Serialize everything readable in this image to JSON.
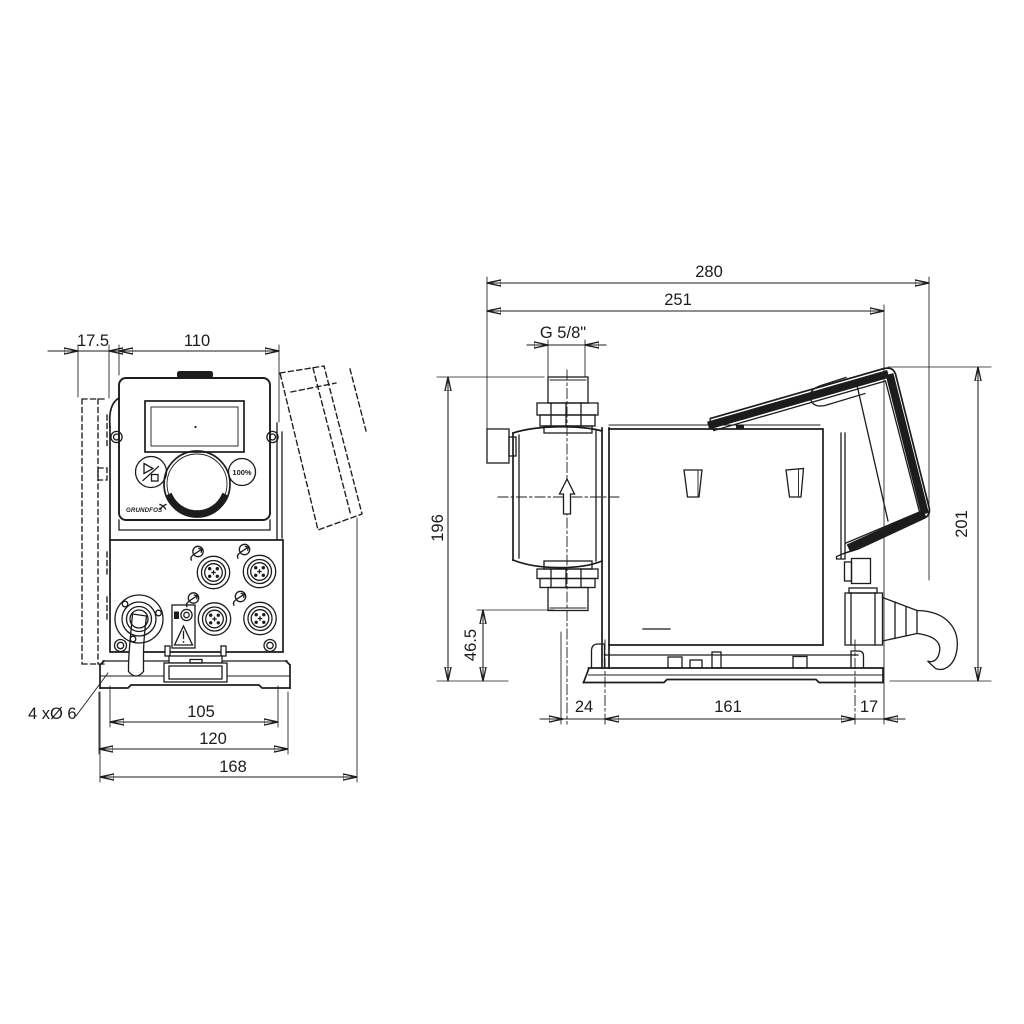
{
  "title": "Dosing pump dimensional drawing",
  "front_view": {
    "dims": {
      "wall_offset": "17.5",
      "panel_width": "110",
      "hole_spacing": "105",
      "plate_width": "120",
      "overall_width": "168"
    },
    "holes_label": "4 xØ 6",
    "panel": {
      "logo": "GRUNDFOS",
      "max_button": "100%"
    }
  },
  "side_view": {
    "dims": {
      "overall_depth": "280",
      "depth_to_mount": "251",
      "thread": "G 5/8\"",
      "head_height": "196",
      "overall_height": "201",
      "suction_offset": "46.5",
      "front_to_hole": "24",
      "hole_spacing": "161",
      "hole_to_rear": "17"
    }
  },
  "icons": {
    "flow_direction_icon": "hollow up-arrow",
    "warning_icon": "exclamation triangle",
    "start_stop_icon": "play/stop",
    "connector_icon": "circular tag",
    "logo_icon": "grundfos-x-swoosh"
  },
  "colors": {
    "line": "#1c1c1c",
    "background": "#ffffff"
  }
}
